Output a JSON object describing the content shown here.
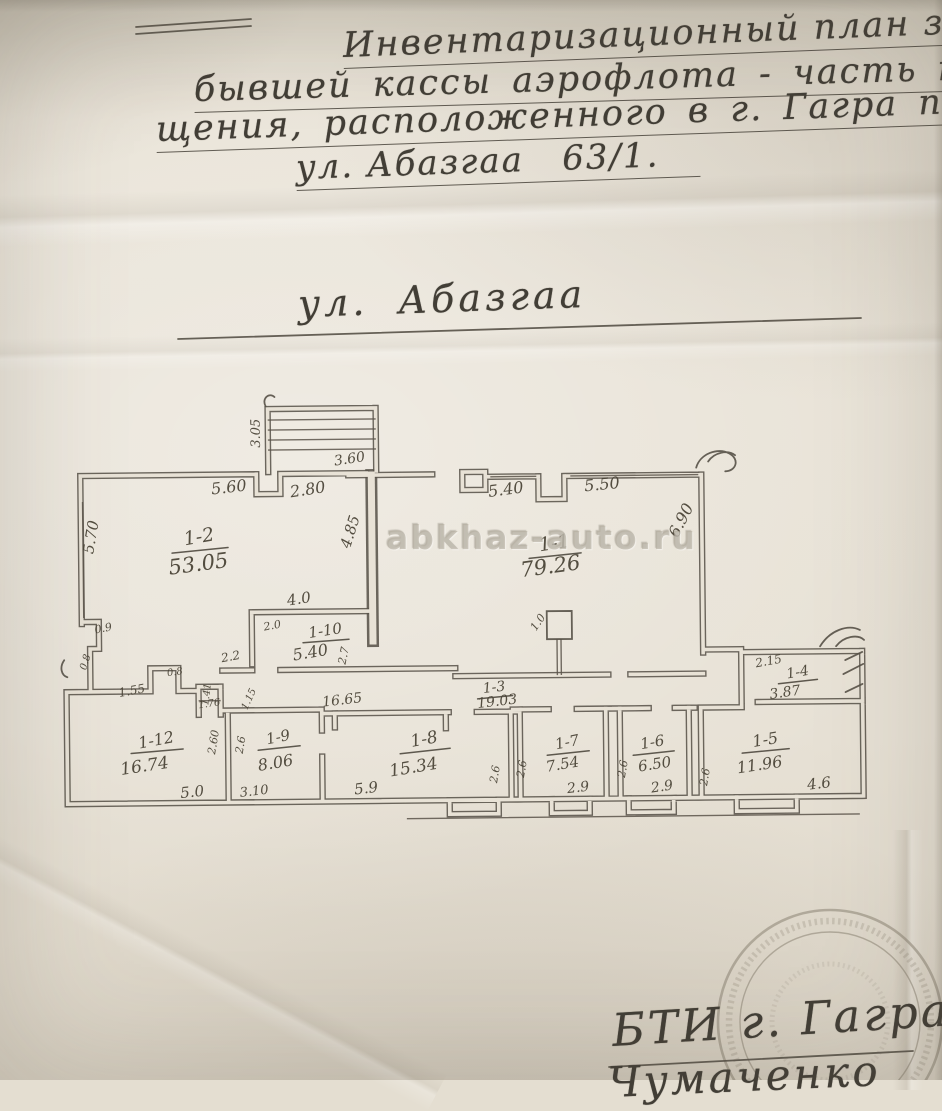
{
  "document": {
    "header": {
      "line1": "Инвентаризационный план здания",
      "line2": "бывшей кассы аэрофлота - часть поме",
      "line3": "щения, расположенного в г. Гагра по",
      "line4": "ул. Абазгаа   63/1."
    },
    "street_label": "ул. Абазгаа",
    "watermark": "abkhaz-auto.ru",
    "stamp": {
      "caption": "БТИ г. Гагра",
      "signature_partial": "Чумаченко"
    }
  },
  "plan": {
    "rooms": [
      {
        "id": "1-2",
        "area": "53.05"
      },
      {
        "id": "1-1",
        "area": "79.26"
      },
      {
        "id": "1-10",
        "area": "5.40"
      },
      {
        "id": "1-3",
        "area": "19.03"
      },
      {
        "id": "1-12",
        "area": "16.74"
      },
      {
        "id": "1-9",
        "area": "8.06"
      },
      {
        "id": "1-8",
        "area": "15.34"
      },
      {
        "id": "1-7",
        "area": "7.54"
      },
      {
        "id": "1-6",
        "area": "6.50"
      },
      {
        "id": "1-5",
        "area": "11.96"
      },
      {
        "id": "1-4",
        "area": "3.87"
      }
    ],
    "dims": {
      "stairs_side": "3.05",
      "stairs_top": "3.60",
      "top_a": "5.60",
      "top_b": "2.80",
      "left_wall": "5.70",
      "mid_wall": "4.85",
      "r1_top_a": "5.40",
      "r1_top_b": "5.50",
      "r1_right": "6.90",
      "r10_top": "4.0",
      "r10_w": "2.0",
      "r10_h": "2.7",
      "column": "1.0",
      "n_09": "0.9",
      "n_08a": "0.8",
      "n_155": "1.55",
      "n_08b": "0.8",
      "n_141": "1.41",
      "n_176": "1.76",
      "n_22": "2.2",
      "n_115": "1.15",
      "hall_len": "16.65",
      "r12_w": "5.0",
      "r12_h": "2.60",
      "r9_h": "2.6",
      "r9_w": "3.10",
      "r8_w": "5.9",
      "r8_h": "2.6",
      "r7_h": "2.6",
      "r7_w": "2.9",
      "r6_h": "2.6",
      "r6_w": "2.9",
      "r5_h": "2.6",
      "r5_w": "4.6",
      "r4_top": "2.15"
    }
  }
}
